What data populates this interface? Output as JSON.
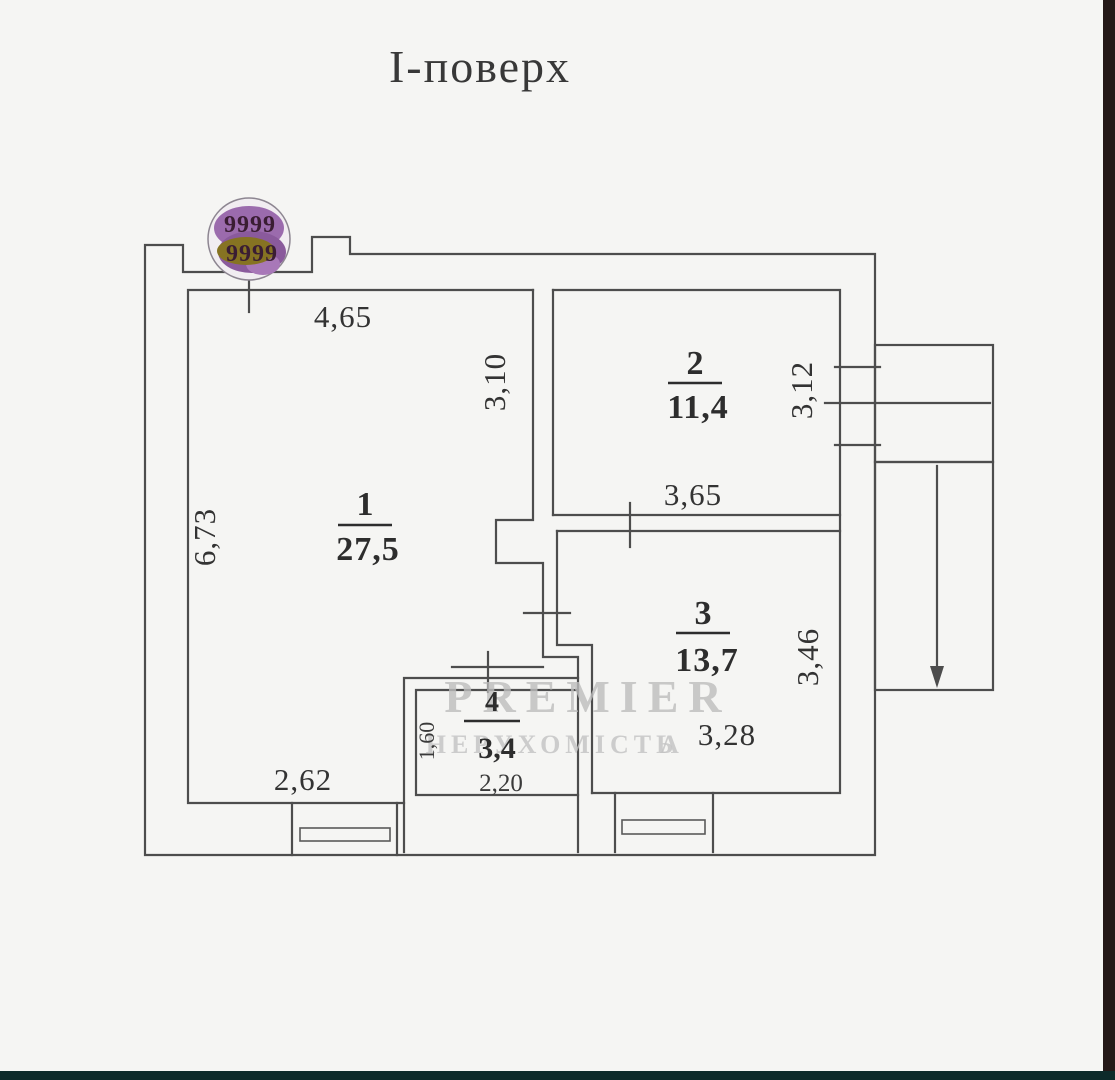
{
  "title": "І-поверх",
  "stamp": {
    "top": "9999",
    "bottom": "9999"
  },
  "watermark": {
    "brand": "PREMIER",
    "subtitle": "НЕРУХОМІСТЬ",
    "mark": "Λ"
  },
  "rooms": [
    {
      "number": "1",
      "area": "27,5"
    },
    {
      "number": "2",
      "area": "11,4"
    },
    {
      "number": "3",
      "area": "13,7"
    },
    {
      "number": "4",
      "area": "3,4"
    }
  ],
  "dimensions": {
    "top_width": "4,65",
    "room1_upper_height": "3,10",
    "room1_height": "6,73",
    "room2_width": "3,65",
    "room2_height": "3,12",
    "room3_height": "3,46",
    "room3_width": "3,28",
    "room1_bottom_width": "2,62",
    "room4_height": "1,60",
    "room4_width": "2,20"
  },
  "colors": {
    "wall": "#4d4d4d",
    "text": "#333333",
    "background": "#f5f5f3",
    "watermark": "#bdbdbd",
    "stamp_purple": "#9b6bad",
    "stamp_olive": "#867322",
    "stamp_text": "#3a1d33",
    "edge_right": "#241817",
    "edge_bottom": "#0d2a2a"
  }
}
